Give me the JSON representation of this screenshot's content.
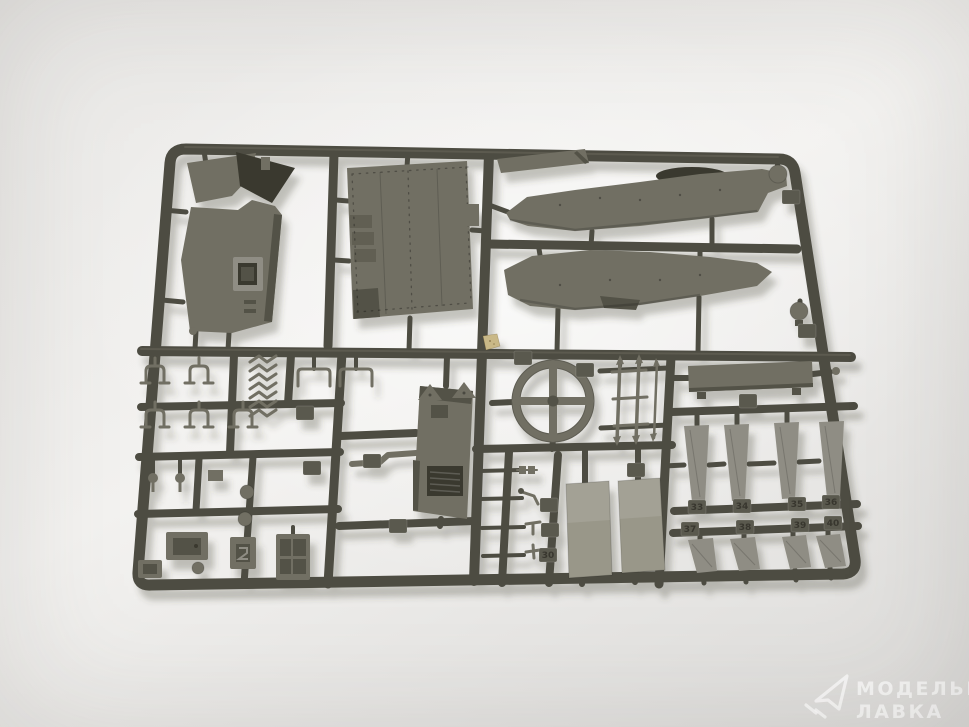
{
  "photo_subject": "model-kit-sprue",
  "watermark": {
    "logo": "paper-plane-icon",
    "line1": "МОДЕЛЬНАЯ",
    "line2": "ЛАВКА"
  },
  "part_tags": {
    "row1": [
      "33",
      "34",
      "35",
      "36"
    ],
    "row2": [
      "37",
      "38",
      "39",
      "40"
    ],
    "misc": [
      "30"
    ]
  },
  "colors": {
    "bg_top": "#e9e8e6",
    "bg_center": "#f3f2f0",
    "bg_bottom": "#dcdbd9",
    "runner": "#4d4c42",
    "runner_hi": "#6e6d60",
    "plastic": "#716f63",
    "plastic_dark": "#535247",
    "plastic_deep": "#3a392f",
    "plastic_light": "#8f8d84",
    "plastic_pale": "#999789",
    "tag": "#5a594e",
    "sticker": "#c9b887",
    "watermark": "rgba(255,255,255,0.72)"
  }
}
